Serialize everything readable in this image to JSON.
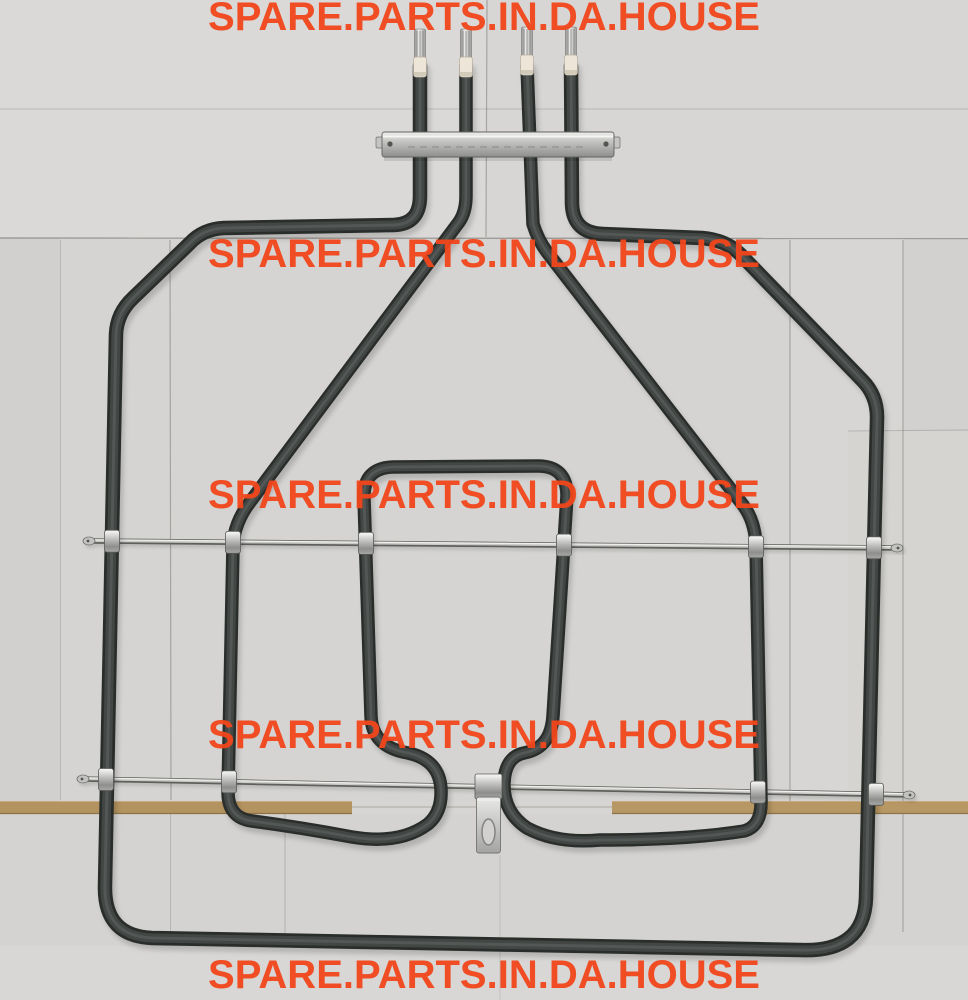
{
  "image": {
    "kind": "product-photo",
    "subject": "Oven grill heating element with four terminal pins, metal mounting bracket, two support rods with clamps and a centre mounting tab, photographed on grey cardboard sheets",
    "width_px": "968",
    "height_px": "1000"
  },
  "watermark": {
    "text": "SPARE.PARTS.IN.DA.HOUSE",
    "color": "#f2461b",
    "row_count": "5"
  },
  "photo": {
    "background_color": "#d6d5d3",
    "tube_color": "#2b2d2c",
    "rod_color": "#5f5f5d",
    "clamp_color": "#d8d8d6",
    "ceramic_color": "#ece5d8",
    "cardboard_strip_color": "#b3935f",
    "terminal_pin_color": "#c0c0be"
  }
}
